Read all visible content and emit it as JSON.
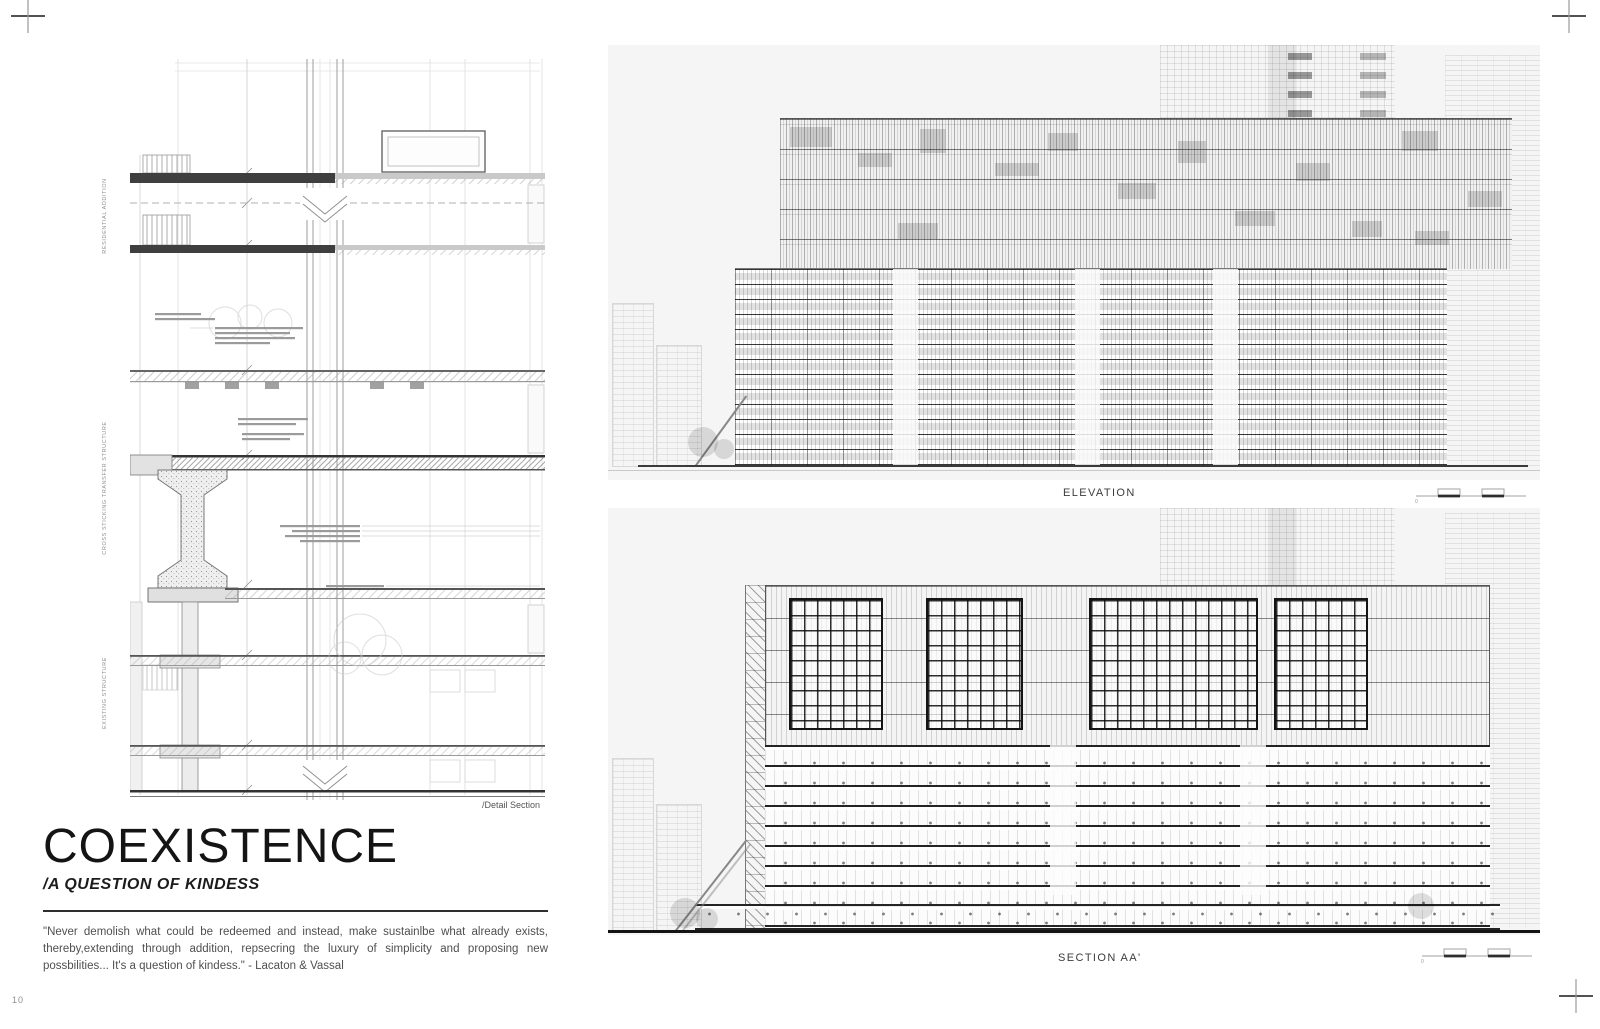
{
  "page": {
    "number": "10"
  },
  "title_block": {
    "title": "COEXISTENCE",
    "subtitle": "/A QUESTION OF KINDESS",
    "quote": "\"Never demolish what could be redeemed and instead, make sustainlbe what already exists, thereby,extending through addition, repsecring the luxury of simplicity and proposing new possbilities... It's a question of kindess.\" - Lacaton & Vassal"
  },
  "detail_drawing": {
    "caption": "/Detail Section",
    "side_labels": [
      {
        "label": "RESIDENTIAL ADDITION"
      },
      {
        "label": "CROSS STICKING TRANSFER STRUCTURE"
      },
      {
        "label": "EXISTING STRUCTURE"
      }
    ]
  },
  "elevation": {
    "caption": "ELEVATION",
    "scale_zero": "0"
  },
  "section": {
    "caption": "SECTION AA'",
    "scale_zero": "0"
  },
  "colors": {
    "panel_bg": "#f5f5f5",
    "ink": "#1a1a1a",
    "muted": "#8f8f8f"
  }
}
